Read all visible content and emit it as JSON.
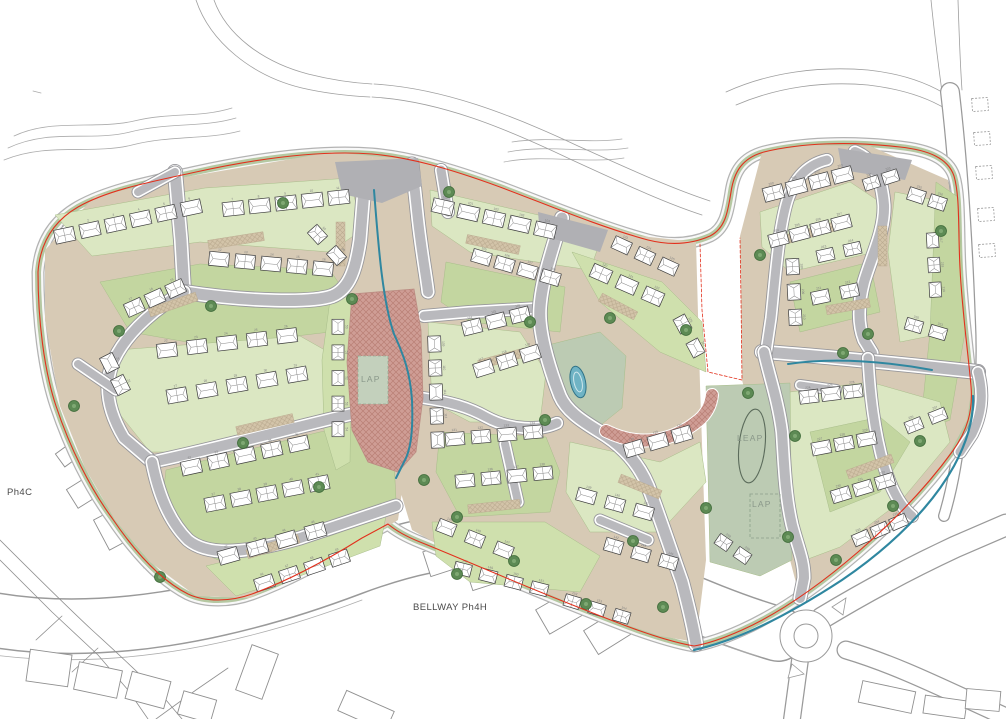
{
  "labels": [
    {
      "text": "Ph4C"
    },
    {
      "text": "BELLWAY Ph4H"
    },
    {
      "text": "LAP"
    },
    {
      "text": "LEAP"
    },
    {
      "text": "LAP"
    }
  ],
  "colors": {
    "asphalt": "#b9b9bd",
    "road_casing": "#97979b",
    "footway": "#f8f8f8",
    "base": "#d7cab5",
    "lawn": "#dbe7c2",
    "lawn2": "#cfe0ad",
    "sage": "#c3d6a0",
    "play_green": "#bccbb3",
    "verge": "#a9bf93",
    "hedge": "#5d8a54",
    "brick": "#cf9d95",
    "brick_line": "#b97f75",
    "boundary_red": "#e2301c",
    "stream_teal": "#2f87a0",
    "pond": "#6fb3c4",
    "house_fill": "#ffffff",
    "house_line": "#3c3c3c",
    "contour": "#ababab",
    "existing_line": "#8f8f8f",
    "number_gray": "#808080"
  },
  "contours": [
    "M8,148 C50,128 90,142 130,132 C170,122 202,128 236,118",
    "M4,160 C48,142 92,155 132,145 C172,135 206,140 240,131",
    "M14,136 C52,118 95,130 134,121 C172,112 200,118 232,108",
    "M508,152 C548,144 588,154 628,148",
    "M504,162 C544,154 584,164 624,158",
    "M512,142 C550,136 586,144 622,139",
    "M884,262 C898,294 906,324 908,354",
    "M894,258 C908,290 916,320 918,350",
    "M33,91 L41,93"
  ],
  "tracks": [
    "M196,0 C210,42 252,76 302,88 C328,94 350,96 370,97",
    "M214,0 C226,34 262,62 308,74 C332,80 354,83 372,84",
    "M372,97 C440,101 505,128 572,160 C618,181 662,202 702,215",
    "M374,84 C442,88 510,114 578,146 C625,167 670,188 710,201",
    "M726,92 C770,72 820,66 868,70 C905,74 932,85 950,97",
    "M736,105 C778,87 824,81 868,85 C902,89 928,98 946,109",
    "M931,0 C934,30 938,62 942,92",
    "M958,0 C959,30 960,62 962,90"
  ],
  "corridor": {
    "d": "M-6,620 C100,638 225,616 352,568 C440,535 512,528 590,560 C652,585 715,616 778,634",
    "w": 56,
    "edges": [
      "M-6,655 C110,670 235,648 362,600",
      "M586,592 C650,615 700,640 758,656"
    ]
  },
  "ext_roads": [
    {
      "d": "M822,618 C865,592 910,568 955,547 L1006,525",
      "w": 23
    },
    {
      "d": "M846,650 C900,666 950,692 1004,716",
      "w": 19
    },
    {
      "d": "M800,660 L792,719",
      "w": 18
    },
    {
      "d": "M950,92 C958,160 963,240 966,320 C968,362 966,392 962,418",
      "w": 20
    },
    {
      "d": "M962,418 C958,456 952,490 944,516",
      "w": 12
    }
  ],
  "ph4c_lines": [
    "M0,560 L52,612 L98,655 L128,690 L148,719",
    "M0,540 C30,570 60,600 92,630 C114,650 138,672 166,700 L182,719",
    "M156,719 L196,690 L228,668",
    "M36,640 L62,616",
    "M72,672 L98,648"
  ],
  "laybys": [
    {
      "x": 972,
      "y": 98
    },
    {
      "x": 974,
      "y": 132
    },
    {
      "x": 976,
      "y": 166
    },
    {
      "x": 978,
      "y": 208
    },
    {
      "x": 979,
      "y": 244
    }
  ],
  "laybars": [
    {
      "x": 928,
      "y": 304,
      "w": 30,
      "h": 11
    },
    {
      "x": 928,
      "y": 328,
      "w": 30,
      "h": 11
    }
  ],
  "roundabout": {
    "cx": 806,
    "cy": 636,
    "r_outer": 26,
    "r_inner": 12
  },
  "existing_buildings": [
    [
      28,
      652,
      42,
      32,
      8
    ],
    [
      76,
      666,
      44,
      28,
      12
    ],
    [
      128,
      676,
      40,
      28,
      15
    ],
    [
      180,
      695,
      34,
      24,
      16
    ],
    [
      243,
      648,
      28,
      48,
      20
    ],
    [
      340,
      700,
      52,
      22,
      24
    ],
    [
      426,
      546,
      34,
      26,
      -18
    ],
    [
      468,
      560,
      34,
      26,
      -18
    ],
    [
      540,
      598,
      40,
      28,
      -30
    ],
    [
      588,
      618,
      40,
      28,
      -32
    ],
    [
      860,
      686,
      54,
      22,
      12
    ],
    [
      924,
      698,
      42,
      18,
      8
    ],
    [
      966,
      690,
      34,
      20,
      5
    ],
    [
      70,
      480,
      30,
      22,
      -32
    ],
    [
      100,
      512,
      26,
      34,
      -28
    ],
    [
      136,
      538,
      30,
      24,
      -30
    ],
    [
      58,
      446,
      22,
      16,
      -36
    ]
  ],
  "boundary": "M38,272 C40,245 52,222 78,207 C108,190 150,182 196,172 C260,158 320,150 372,154 C408,157 448,168 500,187 C548,205 600,227 648,240 C672,246 692,244 710,236 C726,228 728,210 731,192 C734,172 742,158 764,152 C800,143 850,141 900,147 C928,150 948,158 954,176 C960,196 958,230 960,268 C962,310 968,352 971,386 C973,410 968,430 952,452 C928,485 895,520 858,552 C822,583 782,612 742,630 C722,639 706,644 694,646 C660,640 620,624 560,600 C505,578 455,556 420,542 C405,536 395,530 388,524 L362,538 C330,558 290,580 252,594 C230,602 205,602 188,594 C160,580 135,552 112,518 C90,488 70,448 56,406 C44,370 38,320 38,272 Z",
  "internal_boundary": "M700,244 L702,310 L708,372 L742,380 L741,300 L740,238",
  "bases": [
    "45,250 95,196 180,178 332,152 372,156 385,260 400,360 405,470 398,520 355,546 300,572 250,598 196,596 150,562 115,520 85,468 60,406 45,320",
    "372,156 420,160 500,186 575,215 640,236 696,242 700,385 706,560 696,642 660,636 600,616 530,586 455,554 412,530 400,490 396,420 386,300 377,220",
    "740,236 762,152 810,145 870,146 948,180 957,235 963,310 972,386 967,420 945,462 905,510 850,560 800,598 790,560 742,380"
  ],
  "greens": [
    {
      "p": "55,215 205,188 350,178 362,230 330,252 200,242 92,256",
      "f": "lawn"
    },
    {
      "p": "100,282 200,264 330,270 350,300 330,332 210,346 130,332",
      "f": "sage"
    },
    {
      "p": "118,350 300,336 346,362 342,420 232,452 150,452 110,402",
      "f": "lawn"
    },
    {
      "p": "166,470 320,432 392,422 396,500 330,532 232,566 186,546 162,506",
      "f": "sage"
    },
    {
      "p": "206,566 330,536 386,516 380,546 300,576 236,596",
      "f": "lawn2"
    },
    {
      "p": "330,300 352,296 350,462 336,470 324,430 322,360",
      "f": "lawn2"
    },
    {
      "p": "430,190 560,220 600,242 590,270 470,252 432,226",
      "f": "lawn"
    },
    {
      "p": "446,262 565,287 560,332 470,322 441,302",
      "f": "sage"
    },
    {
      "p": "428,322 520,332 546,372 540,422 470,422 432,402",
      "f": "lawn"
    },
    {
      "p": "572,252 662,282 702,322 706,372 660,352 600,302",
      "f": "lawn2"
    },
    {
      "p": "552,344 600,332 626,356 622,408 592,432 556,404 546,372",
      "f": "play"
    },
    {
      "p": "440,432 546,437 560,472 550,512 460,517 436,472",
      "f": "sage"
    },
    {
      "p": "570,442 660,462 700,442 706,482 660,532 590,532 566,492",
      "f": "lawn"
    },
    {
      "p": "432,522 545,522 600,556 580,592 470,582 436,556",
      "f": "lawn2"
    },
    {
      "p": "760,212 850,182 880,202 875,252 790,272 762,247",
      "f": "lawn"
    },
    {
      "p": "790,282 870,262 880,312 800,332",
      "f": "sage"
    },
    {
      "p": "895,192 945,202 950,332 900,342 888,252",
      "f": "lawn"
    },
    {
      "p": "936,182 958,197 965,332 950,420 920,432 930,332",
      "f": "sage"
    },
    {
      "p": "790,392 870,382 940,402 950,442 900,502 840,547 800,562 785,482 782,422",
      "f": "lawn"
    },
    {
      "p": "810,432 880,417 910,442 880,492 830,512",
      "f": "sage"
    },
    {
      "p": "706,386 790,383 792,560 760,576 710,562",
      "f": "play"
    }
  ],
  "roads": {
    "left": [
      {
        "d": "M175,172 L181,240 L184,292",
        "w": 11
      },
      {
        "d": "M184,292 C250,302 312,303 332,296 C350,289 356,268 360,240 L364,190",
        "w": 11
      },
      {
        "d": "M184,292 C160,305 128,330 114,360 C104,382 106,408 124,438 L152,462",
        "w": 10
      },
      {
        "d": "M152,462 C210,450 300,426 352,414 L388,408",
        "w": 10
      },
      {
        "d": "M152,462 C158,492 168,520 188,540 C210,558 250,552 300,538 L396,506",
        "w": 10
      },
      {
        "d": "M116,390 L78,364",
        "w": 8
      },
      {
        "d": "M175,172 L138,192",
        "w": 8
      }
    ],
    "middle": [
      {
        "d": "M412,164 L418,220 C422,255 426,275 428,292",
        "w": 10
      },
      {
        "d": "M424,316 L470,312 L540,308",
        "w": 9
      },
      {
        "d": "M562,218 C552,250 542,280 540,307 C538,330 548,365 560,396 C566,410 580,420 600,432 C622,445 638,462 648,486 C658,512 670,548 682,582 C688,605 693,625 696,644",
        "w": 11
      },
      {
        "d": "M423,398 C450,402 468,407 486,417 C510,430 540,431 557,423",
        "w": 9
      },
      {
        "d": "M441,170 L448,212",
        "w": 9
      },
      {
        "d": "M505,444 L518,502",
        "w": 8
      },
      {
        "d": "M600,520 L648,540",
        "w": 8
      }
    ],
    "right": [
      {
        "d": "M855,152 C875,160 882,180 884,205 C885,230 872,255 864,282 C858,305 858,325 864,340 L872,353",
        "w": 10
      },
      {
        "d": "M762,352 C800,354 860,360 920,366 L978,372",
        "w": 11
      },
      {
        "d": "M766,352 L771,318 C775,280 778,235 786,205 C792,182 805,165 827,160",
        "w": 9
      },
      {
        "d": "M764,352 C768,372 778,400 782,432 C784,462 785,495 792,525 C798,548 804,560 804,578 L800,598",
        "w": 10
      },
      {
        "d": "M868,358 C870,395 874,430 884,466 C892,492 902,508 912,516",
        "w": 9
      },
      {
        "d": "M978,372 C984,394 982,414 972,434 L960,452",
        "w": 9
      },
      {
        "d": "M800,385 L836,390",
        "w": 7
      }
    ]
  },
  "plates": [
    "335,162 418,158 422,186 382,203 342,194",
    "538,212 608,230 600,252 540,235",
    "838,148 912,160 905,180 842,170"
  ],
  "plaza": "352,294 414,289 421,330 423,398 416,452 398,472 368,462 352,430 347,362",
  "brick_street": "M606,431 C640,448 674,441 699,420 C707,413 711,404 712,395",
  "play_areas": {
    "lap_square": {
      "x": 358,
      "y": 356,
      "w": 30,
      "h": 48
    },
    "lap_dashed": {
      "x": 750,
      "y": 494,
      "w": 30,
      "h": 44
    },
    "leap_oval": {
      "cx": 752,
      "cy": 446,
      "rx": 13,
      "ry": 37,
      "rot": 6
    }
  },
  "swales": [
    "M374,190 C378,240 382,300 394,334 C404,356 410,372 412,400 C413,425 412,448 404,462 L396,478",
    "M788,364 C835,357 890,362 932,370"
  ],
  "stream": "M694,650 C740,640 790,614 842,580 C892,546 932,506 954,466 C968,440 974,416 973,396",
  "pond": {
    "cx": 578,
    "cy": 382,
    "rx": 7.5,
    "ry": 16,
    "rot": -12
  },
  "drives": [
    [
      208,
      236,
      56,
      9,
      -9
    ],
    [
      148,
      300,
      50,
      9,
      -19
    ],
    [
      236,
      420,
      58,
      9,
      -13
    ],
    [
      246,
      542,
      54,
      9,
      -17
    ],
    [
      466,
      240,
      54,
      9,
      12
    ],
    [
      478,
      354,
      48,
      9,
      -15
    ],
    [
      598,
      302,
      40,
      9,
      28
    ],
    [
      468,
      502,
      52,
      9,
      -6
    ],
    [
      618,
      482,
      44,
      9,
      22
    ],
    [
      788,
      228,
      48,
      9,
      -15
    ],
    [
      826,
      302,
      44,
      9,
      -10
    ],
    [
      846,
      462,
      48,
      9,
      -20
    ],
    [
      878,
      226,
      9,
      40,
      0
    ],
    [
      336,
      222,
      9,
      44,
      0
    ]
  ],
  "house_clusters": [
    {
      "name": "west",
      "plot_start": 1,
      "rows": [
        [
          52,
          238,
          204,
          205,
          6,
          20,
          14
        ],
        [
          220,
          210,
          352,
          196,
          5,
          21,
          14
        ],
        [
          206,
          258,
          336,
          270,
          5,
          20,
          14
        ],
        [
          124,
          312,
          186,
          284,
          3,
          18,
          14
        ],
        [
          104,
          352,
          126,
          396,
          2,
          17,
          14
        ],
        [
          152,
          352,
          302,
          334,
          5,
          20,
          14
        ],
        [
          162,
          398,
          312,
          372,
          5,
          20,
          14
        ],
        [
          178,
          470,
          312,
          441,
          5,
          20,
          14
        ],
        [
          202,
          506,
          332,
          481,
          5,
          20,
          14
        ],
        [
          214,
          560,
          330,
          527,
          4,
          20,
          14
        ],
        [
          252,
          587,
          352,
          554,
          4,
          19,
          13
        ],
        [
          338,
          314,
          338,
          442,
          5,
          15,
          12
        ],
        [
          308,
          224,
          346,
          266,
          2,
          16,
          13
        ]
      ]
    },
    {
      "name": "central",
      "plot_start": 100,
      "rows": [
        [
          430,
          204,
          558,
          233,
          5,
          21,
          14
        ],
        [
          470,
          254,
          562,
          281,
          4,
          19,
          13
        ],
        [
          434,
          332,
          438,
          452,
          5,
          16,
          13
        ],
        [
          460,
          330,
          532,
          312,
          3,
          19,
          14
        ],
        [
          472,
          372,
          542,
          350,
          3,
          19,
          14
        ],
        [
          588,
          268,
          666,
          302,
          3,
          20,
          14
        ],
        [
          610,
          240,
          680,
          272,
          3,
          18,
          13
        ],
        [
          676,
          312,
          702,
          360,
          2,
          16,
          13
        ],
        [
          622,
          452,
          694,
          431,
          3,
          19,
          14
        ],
        [
          442,
          440,
          546,
          431,
          4,
          19,
          13
        ],
        [
          452,
          482,
          556,
          472,
          4,
          19,
          13
        ],
        [
          572,
          492,
          658,
          516,
          3,
          19,
          13
        ],
        [
          600,
          542,
          682,
          566,
          3,
          18,
          13
        ],
        [
          432,
          522,
          518,
          556,
          3,
          18,
          13
        ],
        [
          450,
          566,
          552,
          592,
          4,
          17,
          12
        ],
        [
          560,
          598,
          634,
          620,
          3,
          16,
          12
        ]
      ]
    },
    {
      "name": "east",
      "plot_start": 200,
      "rows": [
        [
          762,
          196,
          854,
          172,
          4,
          20,
          14
        ],
        [
          768,
          242,
          852,
          220,
          4,
          19,
          13
        ],
        [
          792,
          254,
          796,
          330,
          3,
          16,
          13
        ],
        [
          806,
          300,
          864,
          288,
          2,
          18,
          13
        ],
        [
          812,
          258,
          866,
          246,
          2,
          17,
          12
        ],
        [
          906,
          192,
          948,
          206,
          2,
          17,
          13
        ],
        [
          932,
          228,
          936,
          302,
          3,
          15,
          12
        ],
        [
          902,
          322,
          950,
          336,
          2,
          17,
          12
        ],
        [
          862,
          186,
          900,
          174,
          2,
          16,
          12
        ],
        [
          798,
          398,
          864,
          390,
          3,
          19,
          13
        ],
        [
          810,
          450,
          878,
          437,
          3,
          19,
          13
        ],
        [
          830,
          498,
          896,
          478,
          3,
          19,
          13
        ],
        [
          852,
          542,
          908,
          518,
          3,
          17,
          12
        ],
        [
          902,
          430,
          950,
          411,
          2,
          17,
          12
        ],
        [
          714,
          536,
          752,
          562,
          2,
          15,
          12
        ]
      ]
    }
  ],
  "trees": [
    [
      283,
      203
    ],
    [
      449,
      192
    ],
    [
      530,
      322
    ],
    [
      610,
      318
    ],
    [
      686,
      330
    ],
    [
      788,
      537
    ],
    [
      843,
      353
    ],
    [
      74,
      406
    ],
    [
      160,
      577
    ],
    [
      243,
      443
    ],
    [
      319,
      487
    ],
    [
      424,
      480
    ],
    [
      457,
      517
    ],
    [
      545,
      420
    ],
    [
      633,
      541
    ],
    [
      706,
      508
    ],
    [
      748,
      393
    ],
    [
      795,
      436
    ],
    [
      941,
      231
    ],
    [
      893,
      506
    ],
    [
      760,
      255
    ],
    [
      920,
      441
    ],
    [
      868,
      334
    ],
    [
      352,
      299
    ],
    [
      211,
      306
    ],
    [
      119,
      331
    ],
    [
      514,
      561
    ],
    [
      586,
      604
    ],
    [
      457,
      574
    ],
    [
      663,
      607
    ],
    [
      836,
      560
    ]
  ]
}
